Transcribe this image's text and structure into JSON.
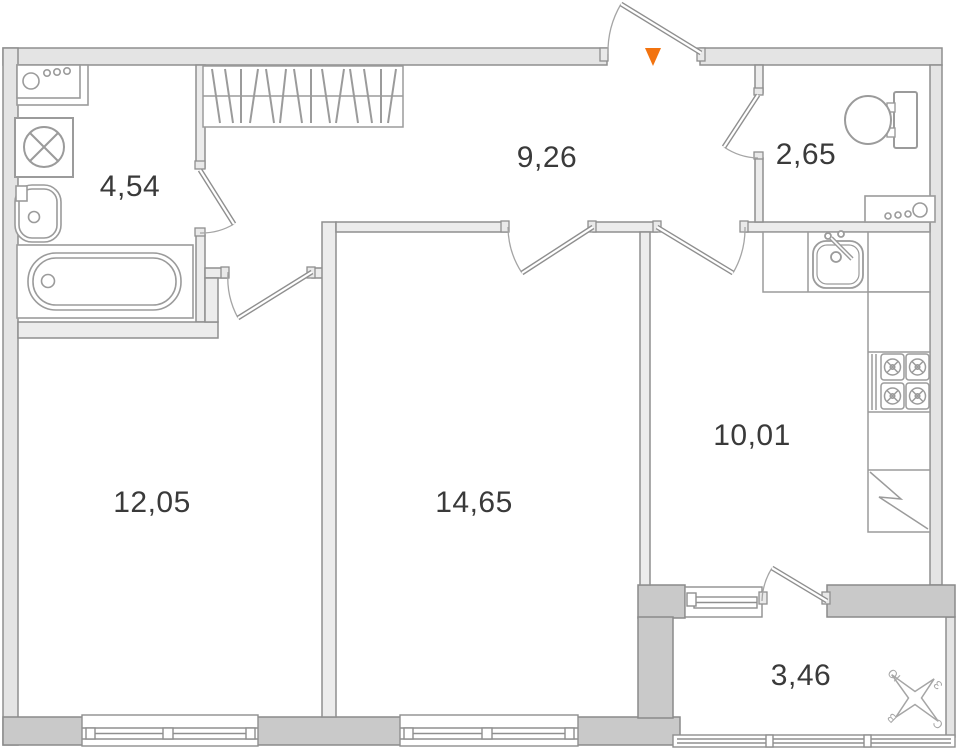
{
  "plan": {
    "rooms": {
      "bathroom": {
        "area": "4,54"
      },
      "hallway": {
        "area": "9,26"
      },
      "toilet": {
        "area": "2,65"
      },
      "bedroom": {
        "area": "12,05"
      },
      "living_room": {
        "area": "14,65"
      },
      "kitchen": {
        "area": "10,01"
      },
      "balcony": {
        "area": "3,46"
      }
    },
    "compass": {
      "north": "С",
      "south": "Ю",
      "west": "З",
      "east": "В"
    },
    "entrance_marker_color": "#f2730f",
    "palette": {
      "wall_light": "#e4e4e4",
      "wall_dark": "#c9c9c9",
      "wall_line": "#8f8f8f",
      "fixture_line": "#9b9b9b",
      "label_text": "#3a3a3a"
    },
    "icons": [
      "entrance-arrow-icon",
      "wardrobe-icon",
      "washer-counter-icon",
      "washing-machine-icon",
      "wash-basin-icon",
      "bathtub-icon",
      "toilet-icon",
      "laundry-machine-icon",
      "kitchen-sink-icon",
      "stove-icon",
      "fridge-icon",
      "window-icon",
      "door-icon",
      "compass-rose-icon"
    ]
  }
}
